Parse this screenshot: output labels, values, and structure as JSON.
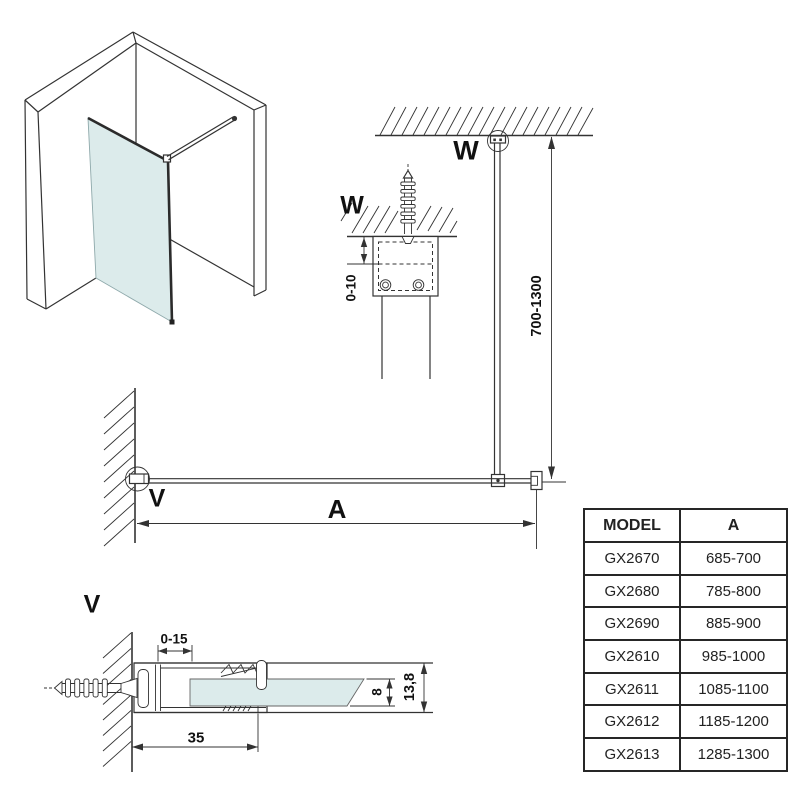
{
  "diagram": {
    "labels": {
      "w": "W",
      "v": "V",
      "a": "A"
    },
    "dims": {
      "bar_height": "700-1300",
      "ceiling_gap": "0-10",
      "glass_inset": "0-15",
      "profile_depth": "35",
      "glass_thickness": "8",
      "profile_height": "13,8"
    },
    "colors": {
      "glass": "#dcebeb",
      "line": "#333333"
    }
  },
  "table": {
    "headers": [
      "MODEL",
      "A"
    ],
    "rows": [
      {
        "model": "GX2670",
        "a": "685-700"
      },
      {
        "model": "GX2680",
        "a": "785-800"
      },
      {
        "model": "GX2690",
        "a": "885-900"
      },
      {
        "model": "GX2610",
        "a": "985-1000"
      },
      {
        "model": "GX2611",
        "a": "1085-1100"
      },
      {
        "model": "GX2612",
        "a": "1185-1200"
      },
      {
        "model": "GX2613",
        "a": "1285-1300"
      }
    ]
  }
}
